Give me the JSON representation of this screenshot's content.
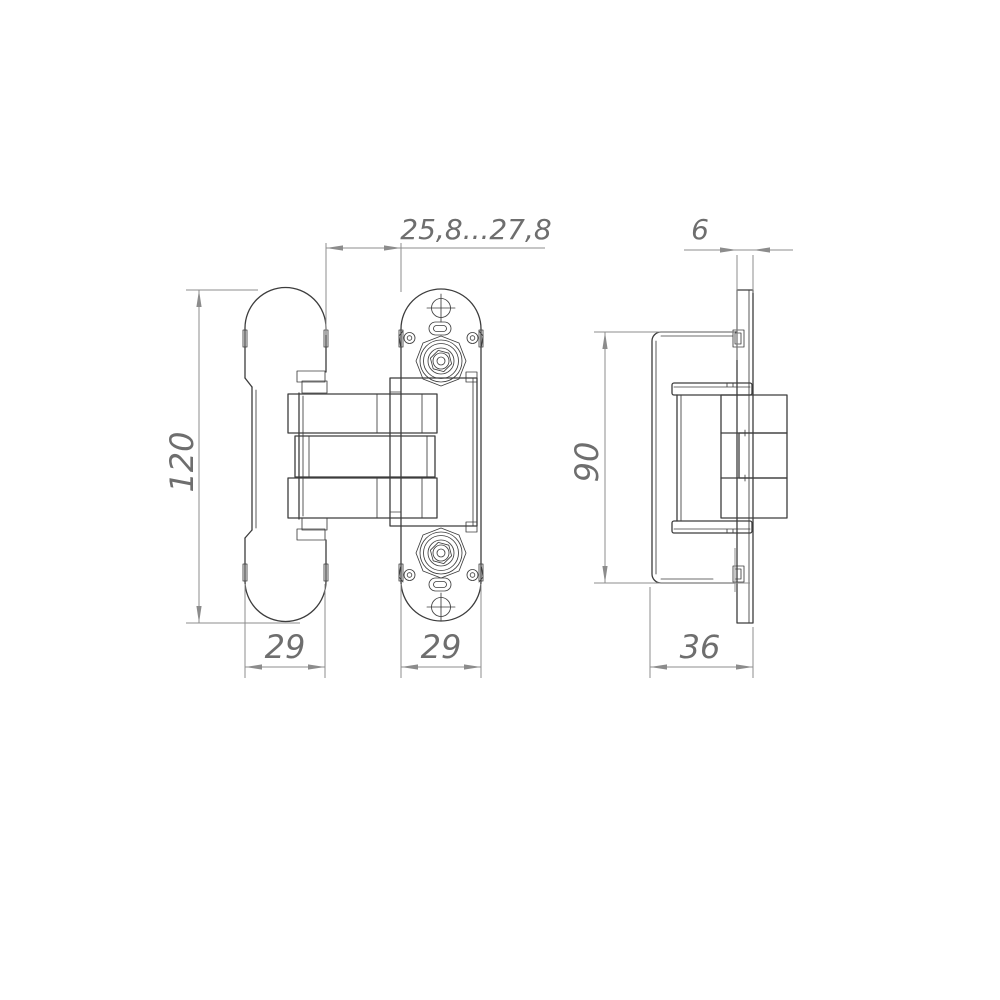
{
  "drawing": {
    "subject": "Concealed door hinge - two-view engineering drawing",
    "view_front": "front elevation with door-leaf plate, three pivot arms and frame plate",
    "view_side": "side section with mortise body and frame plate edge"
  },
  "dimensions": {
    "door_gap_range": "25,8...27,8",
    "frame_plate_thickness": "6",
    "hinge_length": "120",
    "body_length": "90",
    "door_plate_width": "29",
    "frame_plate_width": "29",
    "body_depth": "36"
  },
  "colors": {
    "geometry": "#3d3d3d",
    "dimension": "#8c8c8c",
    "dim_text": "#6e6e6e",
    "background": "#ffffff"
  }
}
